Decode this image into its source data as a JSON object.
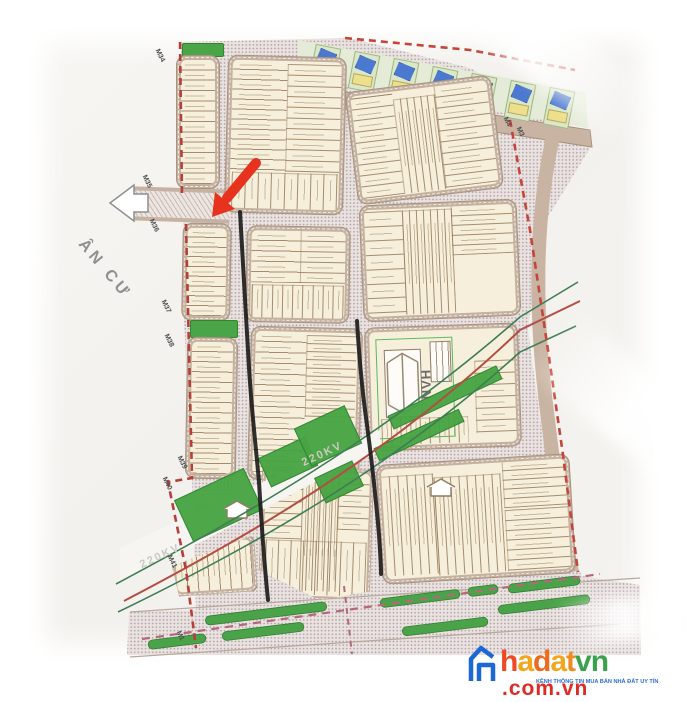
{
  "map": {
    "region_label": "ÂN CƯ",
    "corridor_labels": [
      "220KV",
      "220KV"
    ],
    "nvh_label": "NVH",
    "markers": [
      {
        "label": "M34",
        "x": 160,
        "y": 48
      },
      {
        "label": "M35",
        "x": 147,
        "y": 174
      },
      {
        "label": "M36",
        "x": 154,
        "y": 218
      },
      {
        "label": "M37",
        "x": 166,
        "y": 299
      },
      {
        "label": "M38",
        "x": 169,
        "y": 333
      },
      {
        "label": "M39",
        "x": 182,
        "y": 455
      },
      {
        "label": "M40",
        "x": 167,
        "y": 476
      },
      {
        "label": "M41",
        "x": 172,
        "y": 554
      },
      {
        "label": "M1",
        "x": 181,
        "y": 630
      },
      {
        "label": "M4",
        "x": 508,
        "y": 116
      },
      {
        "label": "M3",
        "x": 521,
        "y": 126
      }
    ],
    "colors": {
      "boundary_dash": "#c0443c",
      "corridor_red": "#b34f42",
      "corridor_green": "#3f7d55",
      "plot_cream": "#f6efdb",
      "block_band": "#c4b1a0",
      "green": "#46a441",
      "stipple": "#e9e2e0",
      "road_brown": "#c9b4a3",
      "annotation_red": "#e7331d",
      "marker_pen": "#1a1a1a"
    }
  },
  "blocks": [
    {
      "id": "green-plot-top",
      "x": 182,
      "y": 43,
      "w": 40,
      "h": 12,
      "green": true
    },
    {
      "id": "left-strip-a",
      "x": 177,
      "y": 56,
      "w": 42,
      "h": 132,
      "rot": 0,
      "sections": [
        {
          "x": 0,
          "y": 0,
          "w": 100,
          "h": 100,
          "dir": "h",
          "n": 12
        }
      ]
    },
    {
      "id": "left-strip-b",
      "x": 183,
      "y": 224,
      "w": 47,
      "h": 96,
      "rot": 1,
      "sections": [
        {
          "x": 0,
          "y": 0,
          "w": 100,
          "h": 100,
          "dir": "h",
          "n": 9
        }
      ]
    },
    {
      "id": "green-plot-mid",
      "x": 190,
      "y": 320,
      "w": 46,
      "h": 16,
      "green": true
    },
    {
      "id": "left-strip-c",
      "x": 187,
      "y": 338,
      "w": 49,
      "h": 140,
      "rot": 1,
      "sections": [
        {
          "x": 0,
          "y": 0,
          "w": 100,
          "h": 100,
          "dir": "h",
          "n": 13
        }
      ]
    },
    {
      "id": "block-top-center",
      "x": 227,
      "y": 57,
      "w": 117,
      "h": 156,
      "rot": 1.5,
      "sections": [
        {
          "x": 0,
          "y": 0,
          "w": 50,
          "h": 74,
          "dir": "h",
          "n": 11
        },
        {
          "x": 50,
          "y": 2,
          "w": 50,
          "h": 72,
          "dir": "h",
          "n": 10,
          "tint": "#f2e8cc"
        },
        {
          "x": 2,
          "y": 76,
          "w": 96,
          "h": 24,
          "dir": "v",
          "n": 8
        }
      ]
    },
    {
      "id": "block-top-right",
      "x": 352,
      "y": 84,
      "w": 145,
      "h": 112,
      "rot": -7,
      "sections": [
        {
          "x": 0,
          "y": 2,
          "w": 31,
          "h": 96,
          "dir": "h",
          "n": 9
        },
        {
          "x": 31,
          "y": 8,
          "w": 30,
          "h": 90,
          "dir": "v",
          "n": 6,
          "tint": "#f2e8cc"
        },
        {
          "x": 61,
          "y": 0,
          "w": 39,
          "h": 98,
          "dir": "h",
          "n": 9
        }
      ]
    },
    {
      "id": "block-mid-left",
      "x": 247,
      "y": 227,
      "w": 102,
      "h": 95,
      "rot": 1,
      "sections": [
        {
          "x": 0,
          "y": 0,
          "w": 52,
          "h": 60,
          "dir": "h",
          "n": 5
        },
        {
          "x": 52,
          "y": 0,
          "w": 48,
          "h": 60,
          "dir": "h",
          "n": 5,
          "tint": "#f2e8cc"
        },
        {
          "x": 1,
          "y": 62,
          "w": 97,
          "h": 38,
          "dir": "v",
          "n": 9
        }
      ]
    },
    {
      "id": "block-mid-right",
      "x": 362,
      "y": 203,
      "w": 156,
      "h": 115,
      "rot": -2.5,
      "sections": [
        {
          "x": 0,
          "y": 2,
          "w": 26,
          "h": 94,
          "dir": "h",
          "n": 7
        },
        {
          "x": 26,
          "y": 2,
          "w": 33,
          "h": 96,
          "dir": "v",
          "n": 7,
          "tint": "#f2e8cc"
        },
        {
          "x": 59,
          "y": 0,
          "w": 41,
          "h": 46,
          "dir": "h",
          "n": 5
        },
        {
          "x": 59,
          "y": 46,
          "w": 41,
          "h": 52,
          "dir": "plain",
          "n": 1
        }
      ]
    },
    {
      "id": "block-tall-left",
      "x": 250,
      "y": 328,
      "w": 110,
      "h": 152,
      "rot": 1.5,
      "sections": [
        {
          "x": 0,
          "y": 0,
          "w": 50,
          "h": 98,
          "dir": "h",
          "n": 13
        },
        {
          "x": 50,
          "y": 2,
          "w": 48,
          "h": 56,
          "dir": "h",
          "n": 10,
          "tint": "#f2e8cc"
        }
      ]
    },
    {
      "id": "block-nvh",
      "x": 367,
      "y": 326,
      "w": 152,
      "h": 122,
      "rot": -2,
      "type": "nvh",
      "sections": [
        {
          "x": 72,
          "y": 28,
          "w": 28,
          "h": 62,
          "dir": "h",
          "n": 6
        },
        {
          "x": 6,
          "y": 76,
          "w": 60,
          "h": 22,
          "dir": "v",
          "n": 9
        }
      ]
    },
    {
      "id": "block-bottom-left",
      "x": 172,
      "y": 538,
      "w": 84,
      "h": 56,
      "rot": -4,
      "clip": "polygon(0 45%,100% 0,100% 100%,6% 100%)",
      "sections": [
        {
          "x": 0,
          "y": 0,
          "w": 100,
          "h": 100,
          "dir": "v",
          "n": 7
        }
      ]
    },
    {
      "id": "block-bottom-center",
      "x": 260,
      "y": 468,
      "w": 112,
      "h": 132,
      "rot": 2,
      "clip": "polygon(0 0,100% 0,100% 92%,55% 100%,0 79%)",
      "sections": [
        {
          "x": 0,
          "y": 4,
          "w": 36,
          "h": 50,
          "dir": "h",
          "n": 5
        },
        {
          "x": 36,
          "y": 0,
          "w": 34,
          "h": 96,
          "dir": "v",
          "n": 6,
          "tint": "#f2e8cc"
        },
        {
          "x": 70,
          "y": 0,
          "w": 30,
          "h": 46,
          "dir": "h",
          "n": 5
        },
        {
          "x": 2,
          "y": 56,
          "w": 96,
          "h": 42,
          "dir": "v",
          "n": 8
        }
      ]
    },
    {
      "id": "block-bottom-right",
      "x": 380,
      "y": 460,
      "w": 192,
      "h": 118,
      "rot": -3.5,
      "sections": [
        {
          "x": 0,
          "y": 6,
          "w": 28,
          "h": 90,
          "dir": "v",
          "n": 6
        },
        {
          "x": 28,
          "y": 10,
          "w": 36,
          "h": 88,
          "dir": "v",
          "n": 8,
          "tint": "#f2e8cc"
        },
        {
          "x": 66,
          "y": 0,
          "w": 34,
          "h": 42,
          "dir": "h",
          "n": 5
        },
        {
          "x": 66,
          "y": 44,
          "w": 34,
          "h": 54,
          "dir": "h",
          "n": 6
        }
      ]
    }
  ],
  "decor": {
    "corridor_patches": [
      {
        "x": 180,
        "y": 482,
        "w": 75,
        "h": 44
      },
      {
        "x": 262,
        "y": 446,
        "w": 50,
        "h": 30
      },
      {
        "x": 300,
        "y": 415,
        "w": 54,
        "h": 40
      },
      {
        "x": 318,
        "y": 468,
        "w": 40,
        "h": 26
      },
      {
        "x": 385,
        "y": 390,
        "w": 118,
        "h": 13
      },
      {
        "x": 372,
        "y": 428,
        "w": 92,
        "h": 12
      }
    ],
    "green_ovals": [
      {
        "x": 205,
        "y": 609,
        "w": 122
      },
      {
        "x": 380,
        "y": 594,
        "w": 80
      },
      {
        "x": 468,
        "y": 586,
        "w": 30
      },
      {
        "x": 508,
        "y": 580,
        "w": 72
      },
      {
        "x": 148,
        "y": 637,
        "w": 58
      },
      {
        "x": 222,
        "y": 627,
        "w": 82
      },
      {
        "x": 402,
        "y": 622,
        "w": 86
      },
      {
        "x": 498,
        "y": 600,
        "w": 92
      }
    ],
    "house_icons": [
      {
        "x": 222,
        "y": 500
      },
      {
        "x": 426,
        "y": 478
      }
    ],
    "villas": {
      "count": 7
    }
  },
  "watermark": {
    "letters": [
      {
        "ch": "h",
        "color": "#ec4b24"
      },
      {
        "ch": "a",
        "color": "#f3a61d"
      },
      {
        "ch": "d",
        "color": "#ec6b1d"
      },
      {
        "ch": "a",
        "color": "#f3a61d"
      },
      {
        "ch": "t",
        "color": "#ee8b1f"
      },
      {
        "ch": "v",
        "color": "#3ba24c"
      },
      {
        "ch": "n",
        "color": "#3ba24c"
      }
    ],
    "suffix": ".com.vn",
    "suffix_color": "#df2c23",
    "tagline": "KÊNH THÔNG TIN MUA BÁN NHÀ ĐẤT UY TÍN",
    "tagline_color": "#2a6fd3",
    "house_color": "#1c67d6"
  }
}
